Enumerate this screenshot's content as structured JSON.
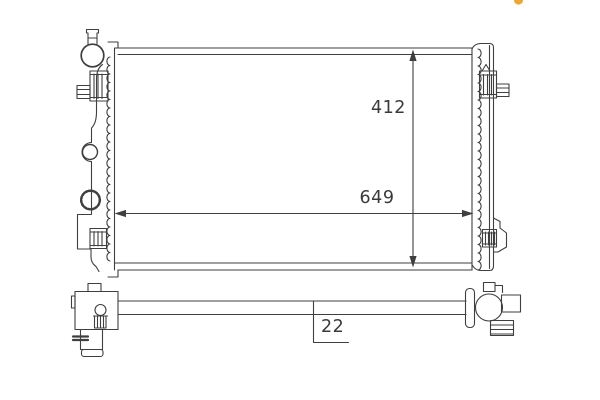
{
  "drawing": {
    "subject": "radiator technical line drawing, front view and side view",
    "dimension_labels": {
      "height": "412",
      "width": "649",
      "thickness": "22"
    },
    "colors": {
      "line": "#3f3f3f",
      "background": "#ffffff",
      "logo_accent": "#eda831"
    }
  }
}
